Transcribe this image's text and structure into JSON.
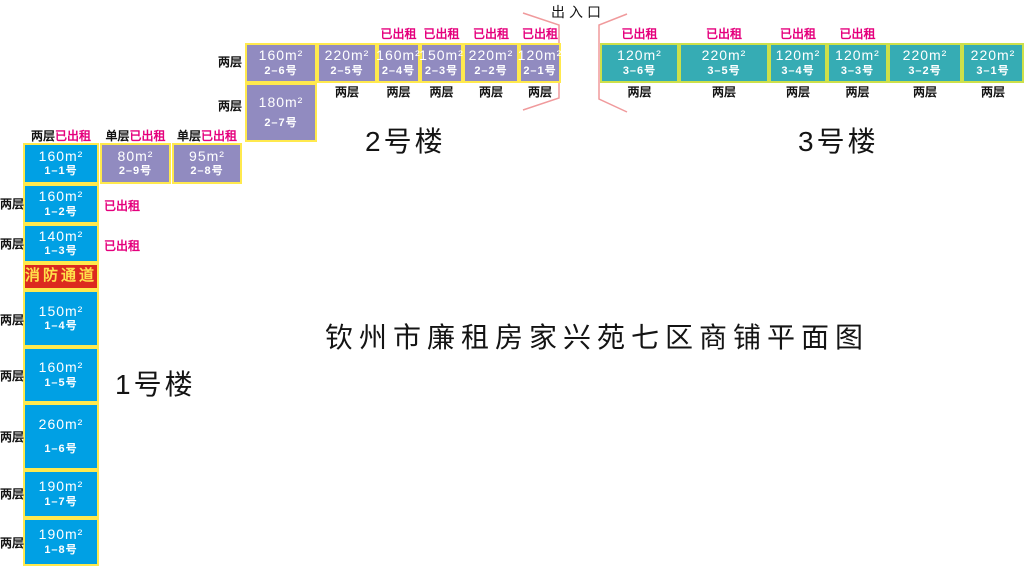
{
  "title": "钦州市廉租房家兴苑七区商铺平面图",
  "entrance_label": "出入口",
  "labels": {
    "rented": "已出租",
    "two_floors": "两层",
    "single_floor": "单层",
    "fire_passage": "消防通道"
  },
  "colors": {
    "building1_fill": "#00a0e4",
    "building2_fill": "#918bc0",
    "building3_fill": "#36acb4",
    "border_yellow": "#ffe94d",
    "border_green_yellow": "#cde04a",
    "fire_fill": "#dc2a1f",
    "fire_text": "#ffe14a",
    "rented_text": "#e5007d",
    "funnel_line": "#f09a9c"
  },
  "building1": {
    "name": "1号楼",
    "headers": [
      {
        "floors": "两层",
        "status": "已出租"
      },
      {
        "floors": "单层",
        "status": "已出租"
      },
      {
        "floors": "单层",
        "status": "已出租"
      }
    ],
    "row1": [
      {
        "area": "160m²",
        "no": "1–1号"
      },
      {
        "area": "80m²",
        "no": "2–9号"
      },
      {
        "area": "95m²",
        "no": "2–8号"
      }
    ],
    "column": [
      {
        "area": "160m²",
        "no": "1–2号"
      },
      {
        "area": "140m²",
        "no": "1–3号"
      },
      {
        "area": "150m²",
        "no": "1–4号"
      },
      {
        "area": "160m²",
        "no": "1–5号"
      },
      {
        "area": "260m²",
        "no": "1–6号"
      },
      {
        "area": "190m²",
        "no": "1–7号"
      },
      {
        "area": "190m²",
        "no": "1–8号"
      }
    ]
  },
  "building2": {
    "name": "2号楼",
    "units": [
      {
        "area": "160m²",
        "no": "2–6号"
      },
      {
        "area": "220m²",
        "no": "2–5号"
      },
      {
        "area": "160m²",
        "no": "2–4号"
      },
      {
        "area": "150m²",
        "no": "2–3号"
      },
      {
        "area": "220m²",
        "no": "2–2号"
      },
      {
        "area": "120m²",
        "no": "2–1号"
      }
    ],
    "unit27": {
      "area": "180m²",
      "no": "2–7号"
    }
  },
  "building3": {
    "name": "3号楼",
    "units": [
      {
        "area": "120m²",
        "no": "3–6号"
      },
      {
        "area": "220m²",
        "no": "3–5号"
      },
      {
        "area": "120m²",
        "no": "3–4号"
      },
      {
        "area": "120m²",
        "no": "3–3号"
      },
      {
        "area": "220m²",
        "no": "3–2号"
      },
      {
        "area": "220m²",
        "no": "3–1号"
      }
    ]
  }
}
